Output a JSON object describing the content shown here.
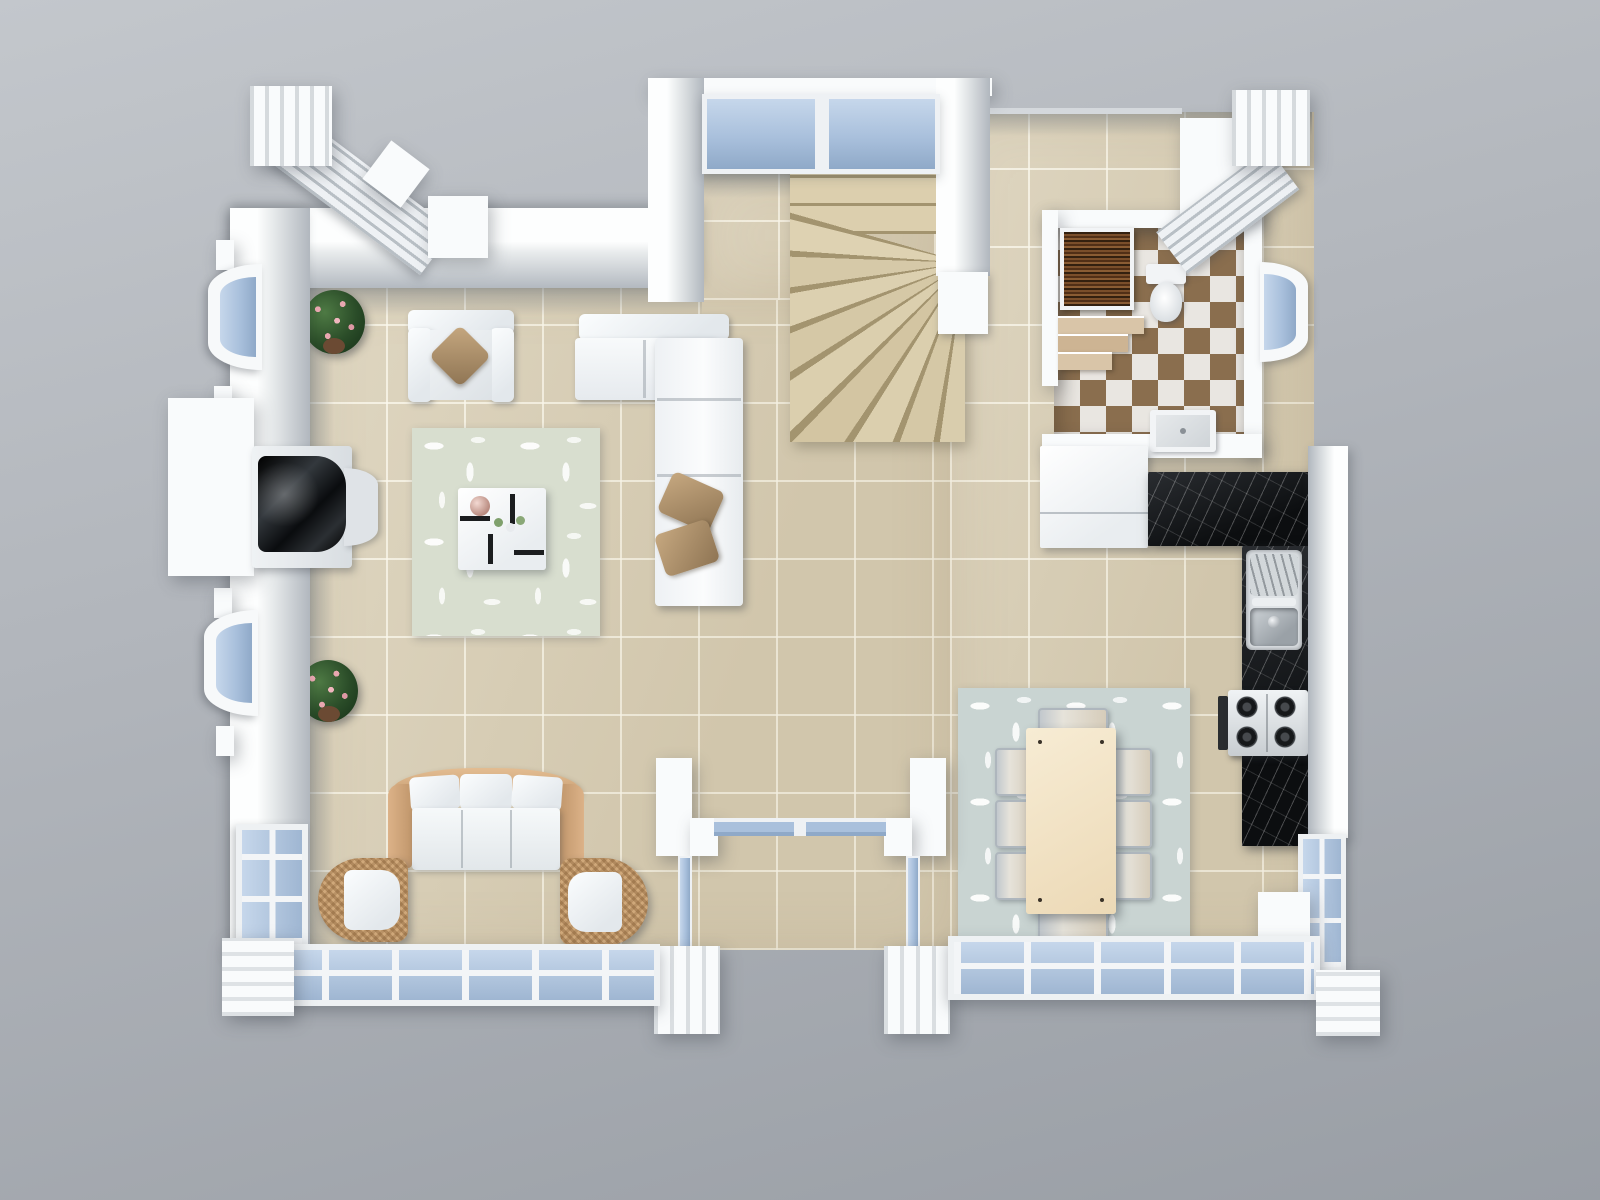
{
  "scene": {
    "title": "3D top-down floor plan render of a one-storey home",
    "rooms": [
      {
        "id": "living-room",
        "floor": "beige-ceramic-tile"
      },
      {
        "id": "lounge-seating-area",
        "floor": "beige-ceramic-tile"
      },
      {
        "id": "stair-hall",
        "floor": "beige-ceramic-tile"
      },
      {
        "id": "kitchen",
        "floor": "beige-ceramic-tile"
      },
      {
        "id": "checkered-bathroom",
        "floor": "brown-white-checkerboard"
      },
      {
        "id": "dining-area",
        "floor": "beige-ceramic-tile"
      },
      {
        "id": "entry-porch",
        "floor": "beige-ceramic-tile"
      }
    ],
    "items": {
      "armchair": "white armchair with tan diamond pillow",
      "sectional_sofa": "white L-shaped sectional sofa with two tan pillows",
      "coffee_table": "white square coffee table with tea set and cups",
      "living_rug": "pale sage rug with white leaf pattern",
      "wood_sofa": "wood-frame three-seat sofa with white cushions",
      "wicker_chair_left": "rattan tub chair with white cushion",
      "wicker_chair_right": "rattan tub chair with white cushion",
      "dining_table": "cream rectangular dining table with eight chrome chairs",
      "dining_rug": "gray-green leaf pattern rug",
      "staircase": "beige winder staircase",
      "kitchen_counter": "black marble L-shaped countertop",
      "sink": "stainless steel sink with drainer",
      "stove": "four-burner gas hob with oven",
      "kitchen_cabinet": "white kitchen cabinet block",
      "wardrobe": "dark wood cabinet",
      "toilet": "white toilet",
      "shower_tray": "white shower tray",
      "bath_steps": "checkered entry steps",
      "fireplace": "black fireplace insert with white surround",
      "plant_top": "potted plant with pink blossoms",
      "plant_bottom": "potted plant with pink blossoms",
      "bay_window": "semicircular bay window with blue glazing",
      "window_wall": "blue glazed window wall with white mullions",
      "entry_glass": "glass entry partition between pillars",
      "porch_pillar": "white crenellated porch pillar",
      "chimney_left": "white chimney cube with slatted duct",
      "chimney_right": "white chimney cube with slatted duct",
      "stair_window": "blue clerestory glazing behind staircase"
    },
    "colors": {
      "ground": "#aeb2b8",
      "wall_white": "#f9fbfc",
      "tile_beige": "#d9cfb6",
      "tile_grout": "#efe8d6",
      "glass_blue": "#a9c0dc",
      "checker_brown": "#8a6e4e",
      "checker_white": "#e9e6e1",
      "marble_black": "#17191c",
      "stair_beige": "#d8cbaa",
      "pillow_tan": "#b29877",
      "wood_frame_tan": "#d9b58c",
      "rug_living": "#d8decf",
      "rug_dining": "#c9d4d2",
      "wood_dark": "#57351d",
      "table_cream": "#f2e3c6"
    }
  }
}
